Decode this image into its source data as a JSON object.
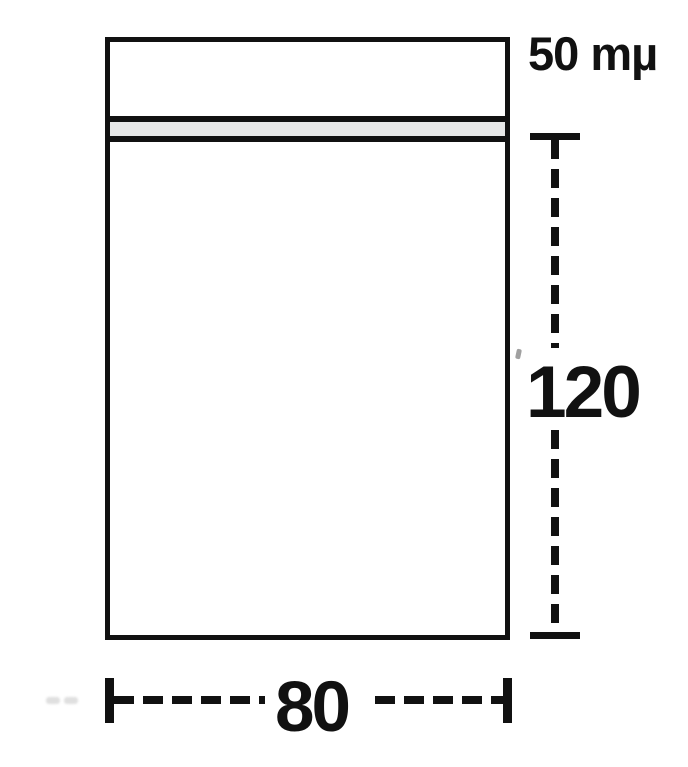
{
  "diagram": {
    "type": "dimension-drawing",
    "subject": "ziplock-bag",
    "thickness_label": "50 mµ",
    "height_label": "120",
    "width_label": "80",
    "dimensions": {
      "width": 80,
      "height": 120,
      "thickness": "50 mµ"
    },
    "colors": {
      "line": "#111111",
      "zip_fill": "#e7e8e8",
      "background": "#ffffff"
    }
  }
}
